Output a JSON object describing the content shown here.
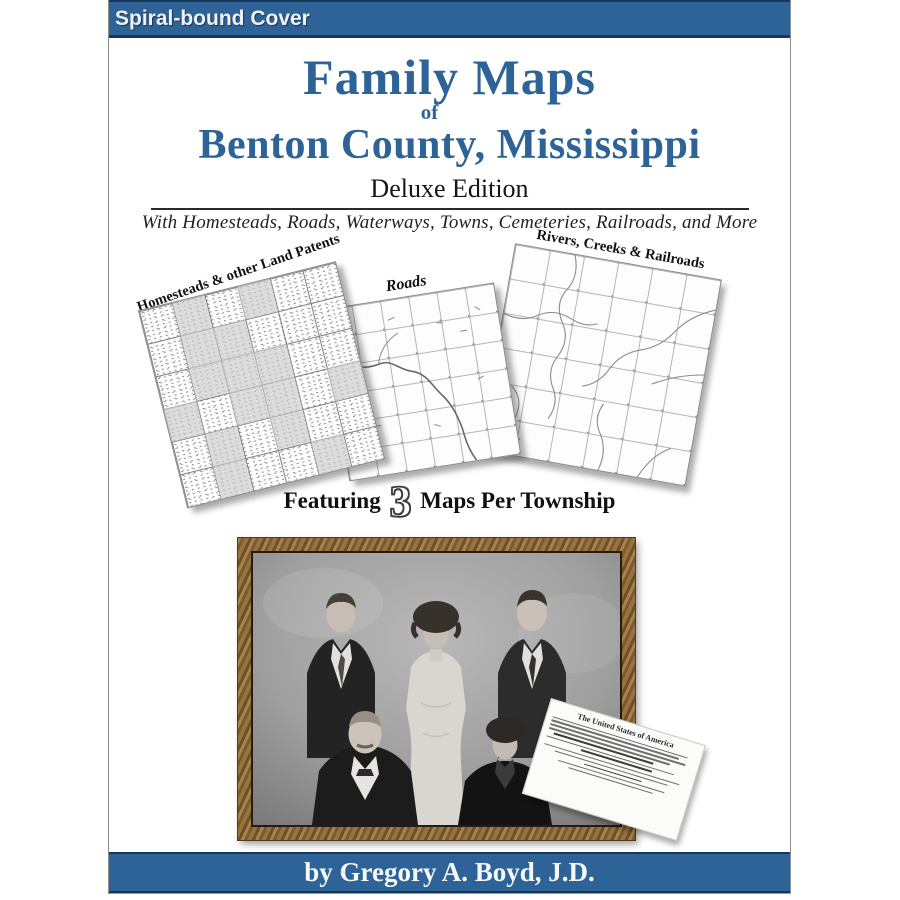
{
  "cover": {
    "banner_label": "Spiral-bound Cover",
    "title_line1": "Family Maps",
    "title_connector": "of",
    "title_line2": "Benton County, Mississippi",
    "edition": "Deluxe Edition",
    "tagline": "With Homesteads, Roads, Waterways, Towns, Cemeteries, Railroads, and More",
    "byline": "by Gregory A. Boyd, J.D."
  },
  "maps": {
    "featuring_prefix": "Featuring",
    "featuring_count": "3",
    "featuring_suffix": "Maps Per Township",
    "items": [
      {
        "label": "Homesteads & other Land Patents",
        "shaded_cells": [
          [
            0,
            1
          ],
          [
            0,
            3
          ],
          [
            1,
            1
          ],
          [
            1,
            2
          ],
          [
            2,
            1
          ],
          [
            2,
            2
          ],
          [
            2,
            3
          ],
          [
            3,
            0
          ],
          [
            3,
            2
          ],
          [
            3,
            3
          ],
          [
            3,
            5
          ],
          [
            4,
            1
          ],
          [
            4,
            3
          ],
          [
            5,
            1
          ],
          [
            5,
            4
          ]
        ]
      },
      {
        "label": "Roads"
      },
      {
        "label": "Rivers, Creeks & Railroads"
      }
    ]
  },
  "document": {
    "header": "The United States of America"
  },
  "colors": {
    "accent_blue": "#2d6396",
    "dark_navy": "#16365c",
    "frame_wood": "#8a6a3b",
    "map_shade": "#cccccc"
  }
}
